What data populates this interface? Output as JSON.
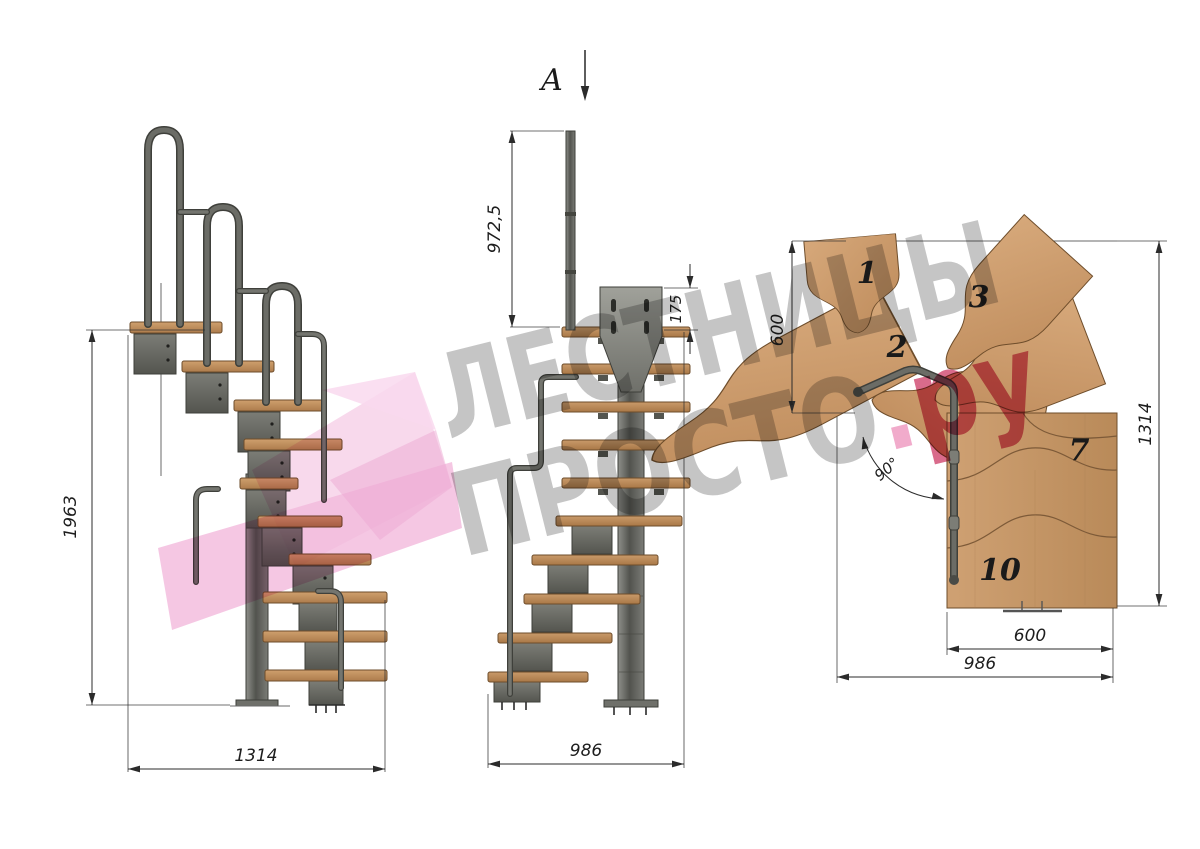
{
  "drawing": {
    "type": "modular-staircase-technical-drawing",
    "views": [
      "side-view",
      "front-view",
      "plan-view"
    ]
  },
  "side_view": {
    "height": "1963",
    "length": "1314"
  },
  "front_view": {
    "section": "A",
    "post_height": "972,5",
    "plate_offset": "175",
    "length": "986"
  },
  "plan_view": {
    "turn_depth": "600",
    "total_depth": "1314",
    "step_width": "600",
    "total_width": "986",
    "angle": "90°",
    "steps": [
      "1",
      "2",
      "3",
      "7",
      "10"
    ]
  },
  "watermark": {
    "line1": "ЛЕСТНИЦЫ",
    "line2": "ПРОСТО",
    "dot": ".",
    "suffix": "ру",
    "gray": "#8f8f8f",
    "crimson": "#d14a72",
    "dot_pink": "#f0a6c8",
    "logo_pink": "#f2b9dc"
  }
}
